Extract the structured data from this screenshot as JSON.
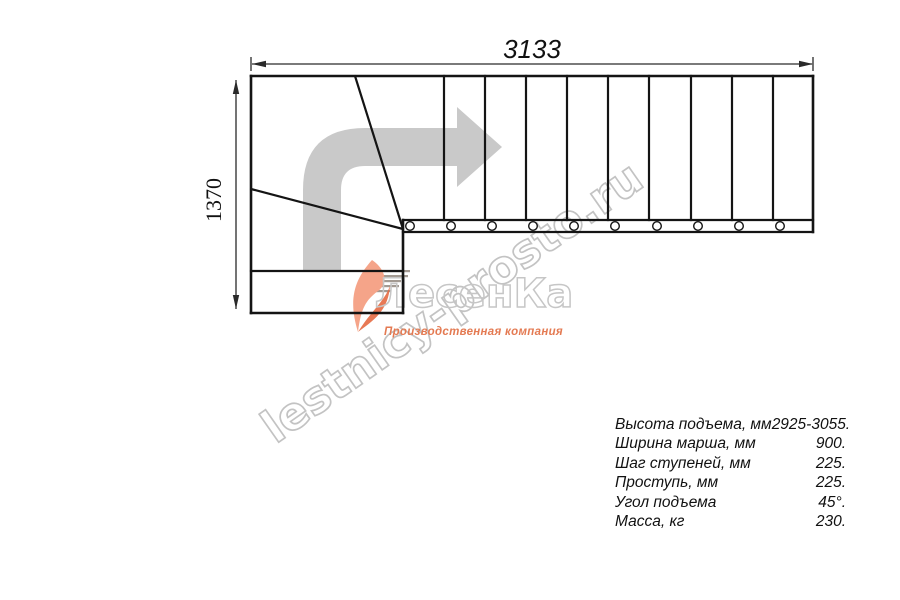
{
  "drawing": {
    "dim_width_label": "3133",
    "dim_height_label": "1370"
  },
  "watermark": {
    "text": "lestnicy-prosto.ru"
  },
  "logo": {
    "brand": "ЛесенКа",
    "subtitle": "Производственная компания"
  },
  "specs": {
    "rows": [
      {
        "label": "Высота подъема, мм",
        "value": "2925-3055."
      },
      {
        "label": "Ширина марша, мм",
        "value": "900."
      },
      {
        "label": "Шаг ступеней, мм",
        "value": "225."
      },
      {
        "label": "Проступь, мм",
        "value": "225."
      },
      {
        "label": "Угол подъема",
        "value": "45°."
      },
      {
        "label": "Масса, кг",
        "value": "230."
      }
    ]
  }
}
